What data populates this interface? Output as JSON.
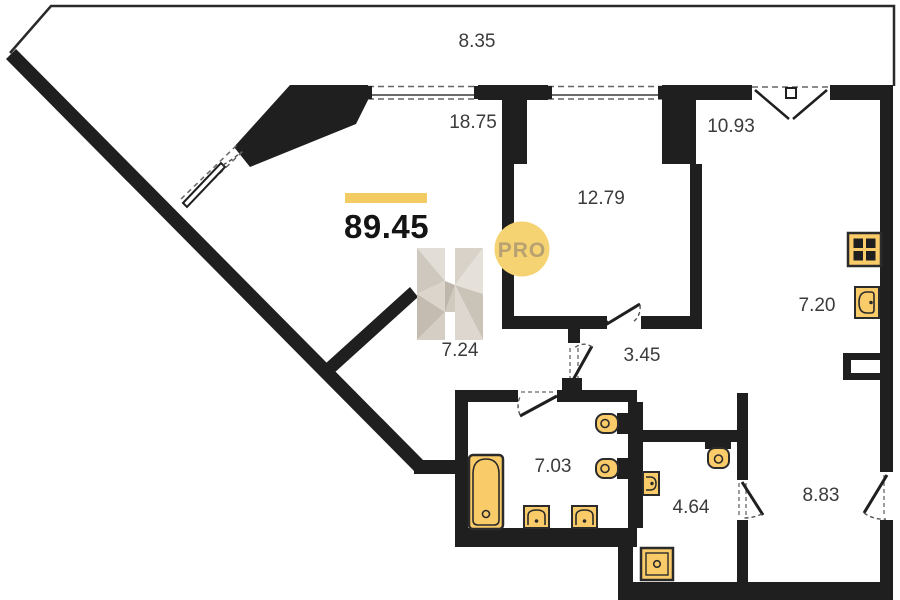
{
  "plan": {
    "type": "apartment-floor-plan",
    "total_area": "89.45",
    "watermark_badge": "PRO",
    "rooms": {
      "balcony": "8.35",
      "living": "18.75",
      "bedroom": "12.79",
      "kitchen_living": "10.93",
      "kitchen": "7.20",
      "nook": "7.24",
      "corridor": "3.45",
      "bathroom": "7.03",
      "wc": "4.64",
      "hall": "8.83"
    },
    "fixtures": [
      "stove-icon",
      "kitchen-sink-icon",
      "bathtub-icon",
      "wash-basin-icon",
      "wash-basin-icon",
      "toilet-icon",
      "toilet-icon",
      "wall-hung-toilet-icon",
      "small-sink-icon",
      "shower-tray-icon"
    ],
    "colors": {
      "wall": "#1f1f1f",
      "outline": "#2a2a2a",
      "accent_bar": "#F2CC63",
      "fixture_fill": "#FACB69",
      "fixture_stroke": "#2b2b2b",
      "badge_bg": "#F6D372",
      "badge_text": "#B7A171",
      "label": "#3b3b3b"
    }
  }
}
